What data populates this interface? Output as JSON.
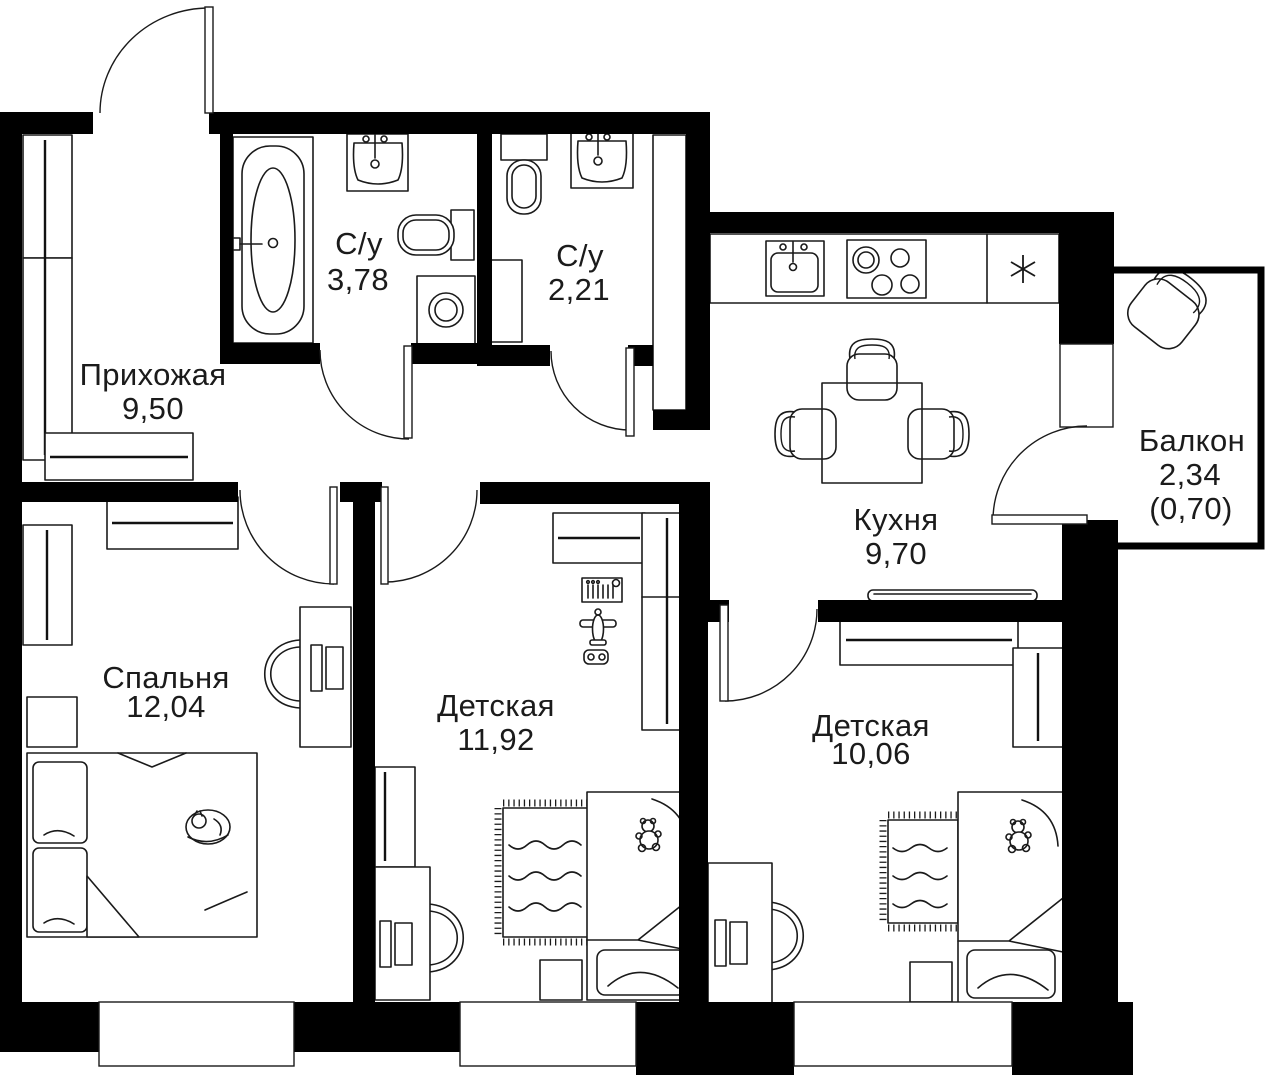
{
  "rooms": {
    "hallway": {
      "name": "Прихожая",
      "area": "9,50"
    },
    "bathroom_large": {
      "name": "С/у",
      "area": "3,78"
    },
    "bathroom_small": {
      "name": "С/у",
      "area": "2,21"
    },
    "kitchen": {
      "name": "Кухня",
      "area": "9,70"
    },
    "balcony": {
      "name": "Балкон",
      "area": "2,34",
      "area_coeff": "(0,70)"
    },
    "bedroom": {
      "name": "Спальня",
      "area": "12,04"
    },
    "nursery_1": {
      "name": "Детская",
      "area": "11,92"
    },
    "nursery_2": {
      "name": "Детская",
      "area": "10,06"
    }
  },
  "icons": {
    "fridge": "✳"
  },
  "colors": {
    "walls": "#000000",
    "lines": "#1a1a1a",
    "text": "#1b1b1b",
    "background": "#ffffff"
  }
}
